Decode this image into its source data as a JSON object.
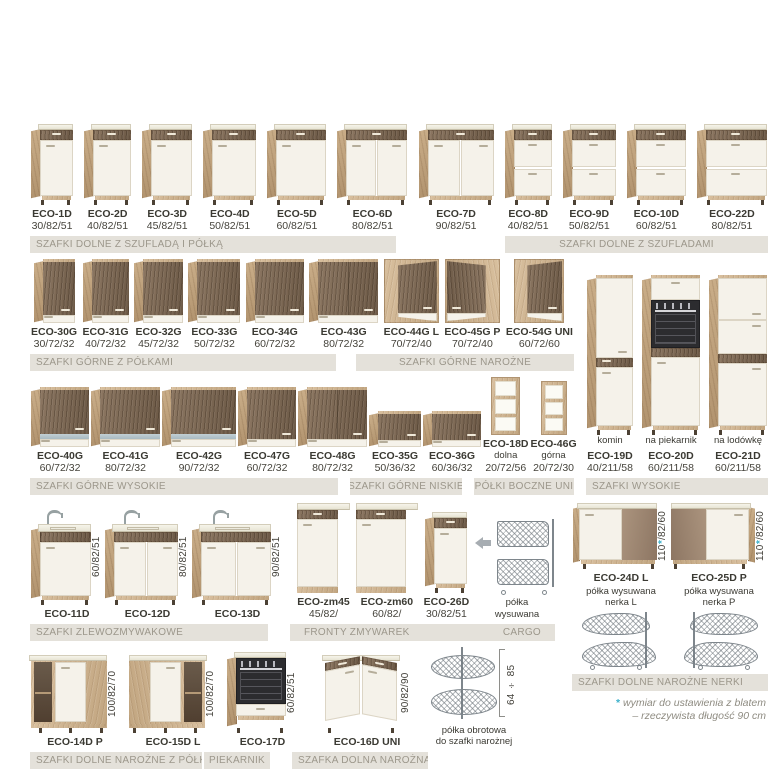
{
  "bars": {
    "dolne_szuflada_polka": "SZAFKI DOLNE Z SZUFLADĄ I PÓŁKĄ",
    "dolne_szufladami": "SZAFKI DOLNE Z SZUFLADAMI",
    "gorne_polkami": "SZAFKI GÓRNE Z PÓŁKAMI",
    "gorne_narozne": "SZAFKI GÓRNE NAROŻNE",
    "wysokie": "SZAFKI WYSOKIE",
    "gorne_wysokie": "SZAFKI GÓRNE WYSOKIE",
    "gorne_niskie": "SZAFKI GÓRNE NISKIE",
    "polki_boczne": "PÓŁKI BOCZNE UNI",
    "zlewozmywakowe": "SZAFKI ZLEWOZMYWAKOWE",
    "fronty": "FRONTY ZMYWAREK",
    "cargo": "CARGO",
    "nerki": "SZAFKI DOLNE NAROŻNE NERKI",
    "narozne_polka": "SZAFKI DOLNE NAROŻNE Z PÓŁKĄ",
    "piekarnik": "PIEKARNIK",
    "dolna_narozna": "SZAFKA DOLNA NAROŻNA"
  },
  "footnote": {
    "star": "*",
    "line1": "wymiar do ustawienia z blatem",
    "line2": "– rzeczywista długość 90 cm",
    "star_color": "#3cb1cb"
  },
  "colors": {
    "wood_light": "#c9ad88",
    "wood_dark": "#7c6753",
    "front_cream": "#f5f2ea",
    "bar_bg": "#e4e1da",
    "bar_text": "#9c978b",
    "glass_blue": "#b3c3ca"
  },
  "groups": {
    "row1": [
      {
        "code": "ECO-1D",
        "dims": "30/82/51",
        "visual": {
          "kind": "base",
          "wu": 30,
          "doors": 1
        }
      },
      {
        "code": "ECO-2D",
        "dims": "40/82/51",
        "visual": {
          "kind": "base",
          "wu": 40,
          "doors": 1
        }
      },
      {
        "code": "ECO-3D",
        "dims": "45/82/51",
        "visual": {
          "kind": "base",
          "wu": 45,
          "doors": 1
        }
      },
      {
        "code": "ECO-4D",
        "dims": "50/82/51",
        "visual": {
          "kind": "base",
          "wu": 50,
          "doors": 1
        }
      },
      {
        "code": "ECO-5D",
        "dims": "60/82/51",
        "visual": {
          "kind": "base",
          "wu": 60,
          "doors": 1
        }
      },
      {
        "code": "ECO-6D",
        "dims": "80/82/51",
        "visual": {
          "kind": "base",
          "wu": 80,
          "doors": 2
        }
      },
      {
        "code": "ECO-7D",
        "dims": "90/82/51",
        "visual": {
          "kind": "base",
          "wu": 90,
          "doors": 2
        }
      },
      {
        "code": "ECO-8D",
        "dims": "40/82/51",
        "visual": {
          "kind": "drawers",
          "wu": 40
        }
      },
      {
        "code": "ECO-9D",
        "dims": "50/82/51",
        "visual": {
          "kind": "drawers",
          "wu": 50
        }
      },
      {
        "code": "ECO-10D",
        "dims": "60/82/51",
        "visual": {
          "kind": "drawers",
          "wu": 60
        }
      },
      {
        "code": "ECO-22D",
        "dims": "80/82/51",
        "visual": {
          "kind": "drawers",
          "wu": 80
        }
      }
    ],
    "row2": [
      {
        "code": "ECO-30G",
        "dims": "30/72/32",
        "visual": {
          "kind": "upper",
          "wu": 30
        }
      },
      {
        "code": "ECO-31G",
        "dims": "40/72/32",
        "visual": {
          "kind": "upper",
          "wu": 40
        }
      },
      {
        "code": "ECO-32G",
        "dims": "45/72/32",
        "visual": {
          "kind": "upper",
          "wu": 45
        }
      },
      {
        "code": "ECO-33G",
        "dims": "50/72/32",
        "visual": {
          "kind": "upper",
          "wu": 50
        }
      },
      {
        "code": "ECO-34G",
        "dims": "60/72/32",
        "visual": {
          "kind": "upper",
          "wu": 60
        }
      },
      {
        "code": "ECO-43G",
        "dims": "80/72/32",
        "visual": {
          "kind": "upper",
          "wu": 80,
          "divider": true
        }
      },
      {
        "code": "ECO-44G L",
        "dims": "70/72/40",
        "visual": {
          "kind": "corner-upper",
          "wu": 70,
          "dir": "L"
        }
      },
      {
        "code": "ECO-45G P",
        "dims": "70/72/40",
        "visual": {
          "kind": "corner-upper",
          "wu": 70,
          "dir": "P"
        }
      },
      {
        "code": "ECO-54G UNI",
        "dims": "60/72/60",
        "visual": {
          "kind": "corner-upper",
          "wu": 60,
          "dir": "U"
        }
      }
    ],
    "tall": [
      {
        "note": "komin",
        "code": "ECO-19D",
        "dims": "40/211/58",
        "visual": {
          "kind": "tall",
          "variant": "plain",
          "wu": 40
        }
      },
      {
        "note": "na piekarnik",
        "code": "ECO-20D",
        "dims": "60/211/58",
        "visual": {
          "kind": "tall",
          "variant": "oven",
          "wu": 60
        }
      },
      {
        "note": "na lodówkę",
        "code": "ECO-21D",
        "dims": "60/211/58",
        "visual": {
          "kind": "tall",
          "variant": "fridge",
          "wu": 60
        }
      }
    ],
    "row3": [
      {
        "code": "ECO-40G",
        "dims": "60/72/32",
        "visual": {
          "kind": "upper",
          "wu": 60,
          "row3": true,
          "blue": true
        }
      },
      {
        "code": "ECO-41G",
        "dims": "80/72/32",
        "visual": {
          "kind": "upper",
          "wu": 80,
          "row3": true,
          "blue": true
        }
      },
      {
        "code": "ECO-42G",
        "dims": "90/72/32",
        "visual": {
          "kind": "upper",
          "wu": 90,
          "row3": true,
          "blue": true
        }
      },
      {
        "code": "ECO-47G",
        "dims": "60/72/32",
        "visual": {
          "kind": "upper",
          "wu": 60,
          "row3": true
        }
      },
      {
        "code": "ECO-48G",
        "dims": "80/72/32",
        "visual": {
          "kind": "upper",
          "wu": 80,
          "row3": true,
          "divider": true
        }
      },
      {
        "code": "ECO-35G",
        "dims": "50/36/32",
        "visual": {
          "kind": "upper",
          "wu": 50,
          "low": true
        }
      },
      {
        "code": "ECO-36G",
        "dims": "60/36/32",
        "visual": {
          "kind": "upper",
          "wu": 60,
          "low": true
        }
      },
      {
        "code": "ECO-18D",
        "sub": "dolna",
        "dims": "20/72/56",
        "visual": {
          "kind": "shelf",
          "tall": true
        }
      },
      {
        "code": "ECO-46G",
        "sub": "górna",
        "dims": "20/72/30",
        "visual": {
          "kind": "shelf"
        }
      }
    ],
    "row4_sinks": [
      {
        "code": "ECO-11D",
        "dims": "60/82/51",
        "vert": true,
        "visual": {
          "kind": "sink",
          "wu": 60,
          "doors": 1
        }
      },
      {
        "code": "ECO-12D",
        "dims": "80/82/51",
        "vert": true,
        "visual": {
          "kind": "sink",
          "wu": 80,
          "doors": 2
        }
      },
      {
        "code": "ECO-13D",
        "dims": "90/82/51",
        "vert": true,
        "visual": {
          "kind": "sink",
          "wu": 90,
          "doors": 2
        }
      }
    ],
    "row4_rest": [
      {
        "code": "ECO-zm45",
        "dims": "45/82/",
        "visual": {
          "kind": "dw",
          "wu": 45
        }
      },
      {
        "code": "ECO-zm60",
        "dims": "60/82/",
        "visual": {
          "kind": "dw",
          "wu": 60
        }
      },
      {
        "code": "ECO-26D",
        "dims": "30/82/51",
        "visual": {
          "kind": "base",
          "wu": 30,
          "doors": 1
        }
      },
      {
        "caption": [
          "półka",
          "wysuwana"
        ],
        "arrow": true,
        "visual": {
          "kind": "cargo"
        }
      }
    ],
    "nerki": [
      {
        "code": "ECO-24D L",
        "dims": "110*/82/60",
        "vert": true,
        "caption": [
          "półka wysuwana",
          "nerka L"
        ],
        "visual": {
          "kind": "nerka",
          "dir": "L"
        },
        "visual2": {
          "kind": "kidney",
          "dir": "L"
        }
      },
      {
        "code": "ECO-25D P",
        "dims": "110*/82/60",
        "vert": true,
        "caption": [
          "półka wysuwana",
          "nerka P"
        ],
        "visual": {
          "kind": "nerka",
          "dir": "P"
        },
        "visual2": {
          "kind": "kidney",
          "dir": "P"
        }
      }
    ],
    "row5": [
      {
        "code": "ECO-14D P",
        "dims": "100/82/70",
        "vert": true,
        "visual": {
          "kind": "corner-shelf",
          "dir": "P"
        }
      },
      {
        "code": "ECO-15D L",
        "dims": "100/82/70",
        "vert": true,
        "visual": {
          "kind": "corner-shelf",
          "dir": "L"
        }
      },
      {
        "code": "ECO-17D",
        "dims": "60/82/51",
        "vert": true,
        "visual": {
          "kind": "oven-base",
          "wu": 60
        }
      },
      {
        "code": "ECO-16D UNI",
        "dims": "90/82/90",
        "vert": true,
        "visual": {
          "kind": "corner-l"
        }
      },
      {
        "caption": [
          "półka obrotowa",
          "do szafki narożnej"
        ],
        "bracket": true,
        "dim": "64 ÷ 85",
        "visual": {
          "kind": "carousel"
        }
      }
    ]
  }
}
